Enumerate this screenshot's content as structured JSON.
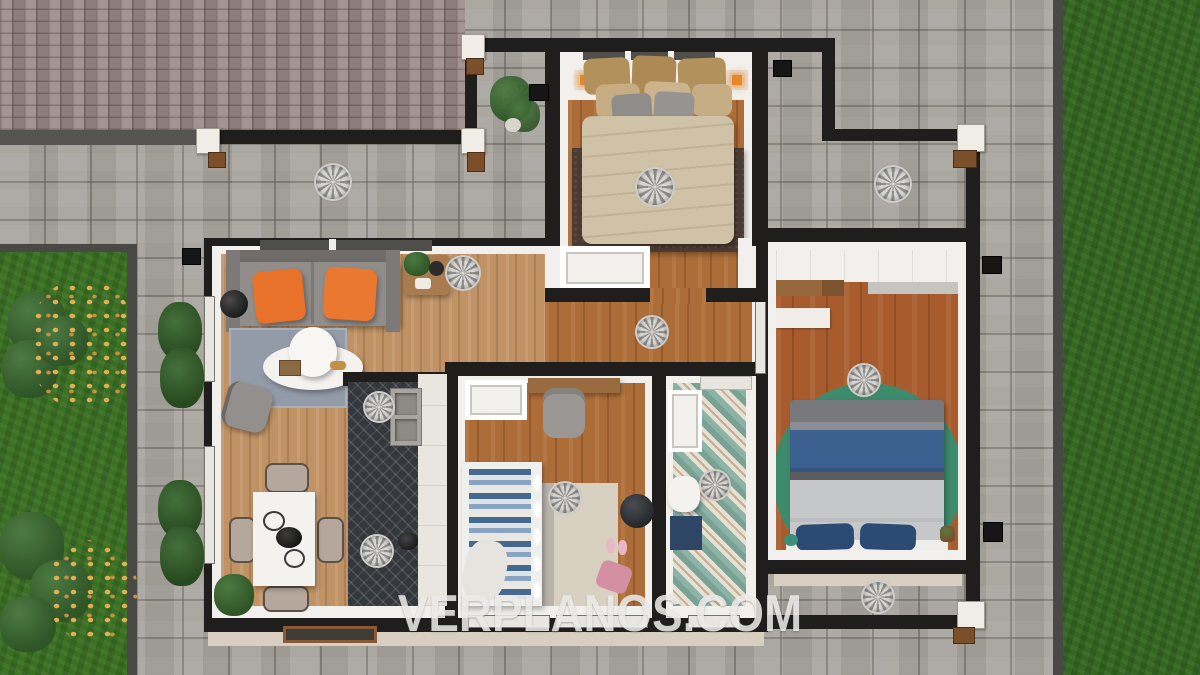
{
  "watermark": {
    "text": "VERPLANOS.COM",
    "color": "#ECEAE7"
  },
  "scene": {
    "type": "3D floor plan render, top-down view"
  },
  "palette": {
    "outer_wall": "#1F1E1C",
    "inner_trim": "#F2F0EC",
    "brick_paving": "#9D8C89",
    "flagstone_paving": "#A7A29C",
    "paving_border": "#4A4845",
    "lawn_left": "#3A7022",
    "lawn_right": "#336620",
    "wood_floor_light": "#C09264",
    "wood_floor_mid": "#AD6D38",
    "wood_floor_red": "#A85C2E",
    "sofa_gray": "#908D8B",
    "cushion_orange": "#E8722A",
    "area_rug_gray": "#939AA8",
    "round_rug_green": "#3E8A6D",
    "bed_rug_brown": "#4B3B32",
    "duvet_beige": "#CFC2A7",
    "duvet_gray": "#C6C7C9",
    "bed_stripe_blue": "#3C6090",
    "pillow_navy": "#2B4A74",
    "kids_bed_blue": "#46698F",
    "kitchen_runner": "#34373C",
    "bath_tile_teal": "#85AFA3",
    "eaves_beige": "#D8CFC0",
    "shrub_green": "#3E6B33",
    "autumn_leaves": "#DCA94F",
    "fan_gray": "#9A9997"
  },
  "icons": {
    "ceiling_fan": "pinwheel medallion",
    "visible_fan_count": 12
  }
}
